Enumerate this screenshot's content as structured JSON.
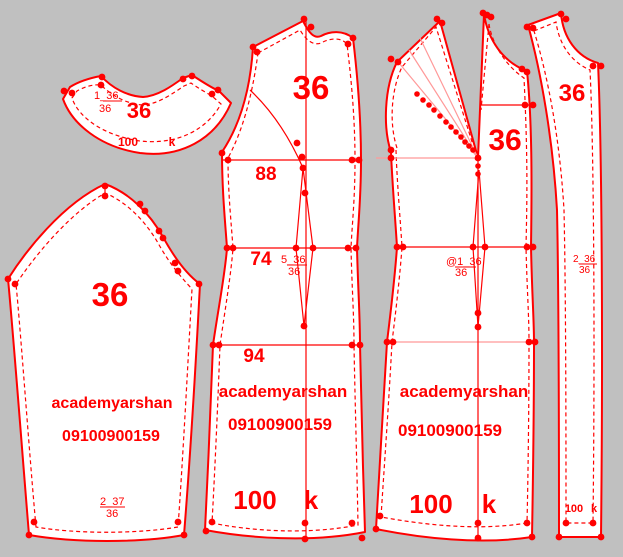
{
  "app": {
    "description": "Garment pattern drafting canvas with five pattern pieces (collar, sleeve, back bodice, front bodice with rotated shoulder dart, front facing strip)"
  },
  "colors": {
    "background": "#c0c0c0",
    "piece_fill": "#ffffff",
    "pattern_line": "#ff0000",
    "construction_light_line": "#ff9999"
  },
  "pieces": {
    "collar": {
      "code": "1_36",
      "code_den": "36",
      "size": "36",
      "scale": "100",
      "grain": "k"
    },
    "sleeve": {
      "size": "36",
      "name": "academyarshan",
      "number": "09100900159",
      "code": "2_37",
      "code_den": "36"
    },
    "back": {
      "size": "36",
      "bust": "88",
      "waist": "74",
      "hip": "94",
      "code": "5_36",
      "code_den": "36",
      "name": "academyarshan",
      "number": "09100900159",
      "scale": "100",
      "grain": "k"
    },
    "front": {
      "size": "36",
      "code": "@1_36",
      "code_den": "36",
      "name": "academyarshan",
      "number": "09100900159",
      "scale": "100",
      "grain": "k"
    },
    "facing": {
      "size": "36",
      "code": "2_36",
      "code_den": "36",
      "scale": "100",
      "grain": "k"
    }
  }
}
